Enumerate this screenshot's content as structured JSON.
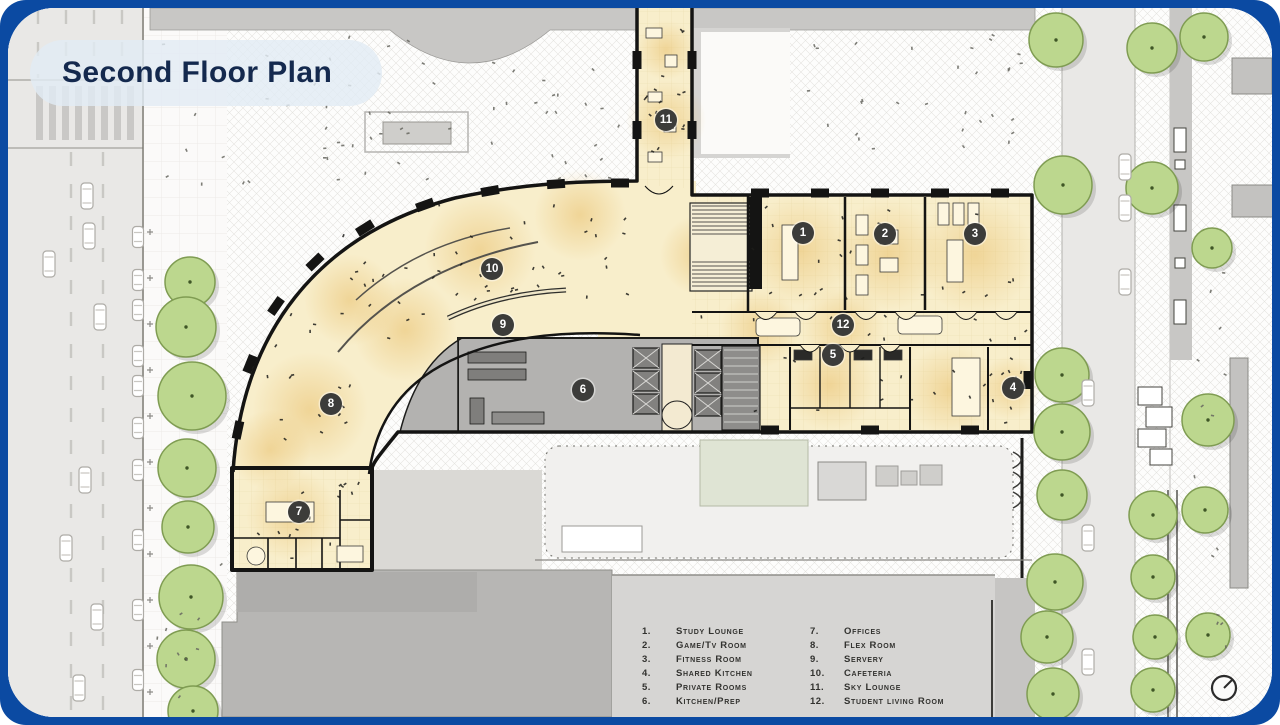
{
  "title": "Second Floor Plan",
  "legend": {
    "items": [
      {
        "num": "1.",
        "label": "Study Lounge"
      },
      {
        "num": "2.",
        "label": "Game/Tv Room"
      },
      {
        "num": "3.",
        "label": "Fitness Room"
      },
      {
        "num": "4.",
        "label": "Shared Kitchen"
      },
      {
        "num": "5.",
        "label": "Private Rooms"
      },
      {
        "num": "6.",
        "label": "Kitchen/Prep"
      },
      {
        "num": "7.",
        "label": "Offices"
      },
      {
        "num": "8.",
        "label": "Flex Room"
      },
      {
        "num": "9.",
        "label": "Servery"
      },
      {
        "num": "10.",
        "label": "Cafeteria"
      },
      {
        "num": "11.",
        "label": "Sky Lounge"
      },
      {
        "num": "12.",
        "label": "Student living Room"
      }
    ]
  },
  "markers": [
    "1",
    "2",
    "3",
    "4",
    "5",
    "6",
    "7",
    "8",
    "9",
    "10",
    "11",
    "12"
  ],
  "colors": {
    "frame": "#0b4aa2",
    "title_text": "#14294e",
    "room_fill": "#f8eecb",
    "room_glow": "#e9c06c",
    "marker_bg": "#3c3c3a",
    "tree_fill": "#bcd78e",
    "road": "#e9e8e6",
    "core_gray": "#b3b2b0"
  }
}
